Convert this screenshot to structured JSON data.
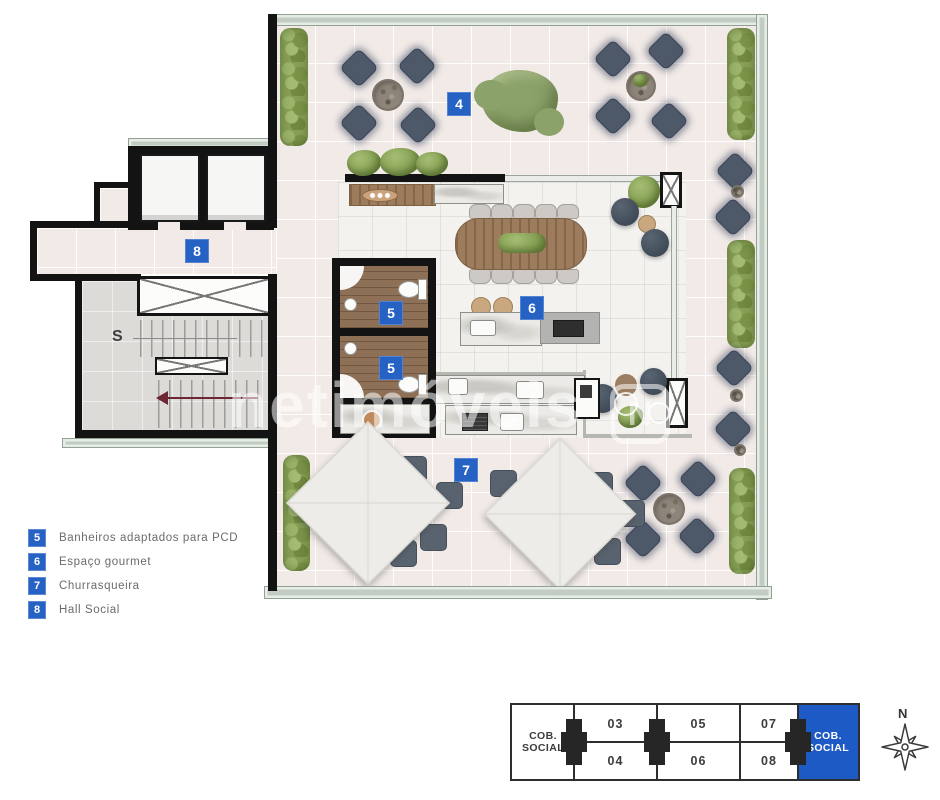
{
  "plan": {
    "area_labels": [
      {
        "id": "terrace-garden",
        "num": "4"
      },
      {
        "id": "hall-social",
        "num": "8"
      },
      {
        "id": "bathroom-pcd-1",
        "num": "5"
      },
      {
        "id": "bathroom-pcd-2",
        "num": "5"
      },
      {
        "id": "espaco-gourmet",
        "num": "6"
      },
      {
        "id": "churrasqueira",
        "num": "7"
      }
    ],
    "stairs_label": "S",
    "label_color": "#2562c4"
  },
  "legend": {
    "items": [
      {
        "num": "5",
        "label": "Banheiros adaptados para PCD"
      },
      {
        "num": "6",
        "label": "Espaço gourmet"
      },
      {
        "num": "7",
        "label": "Churrasqueira"
      },
      {
        "num": "8",
        "label": "Hall Social"
      }
    ]
  },
  "key_plan": {
    "left_cell": "COB.\nSOCIAL",
    "right_cell": "COB.\nSOCIAL",
    "top_units": [
      "03",
      "05",
      "07"
    ],
    "bottom_units": [
      "04",
      "06",
      "08"
    ],
    "highlight_color": "#1d5ac6"
  },
  "compass": {
    "north_label": "N"
  },
  "watermark": {
    "text": "netimóveis",
    "logo_letter": "N"
  }
}
